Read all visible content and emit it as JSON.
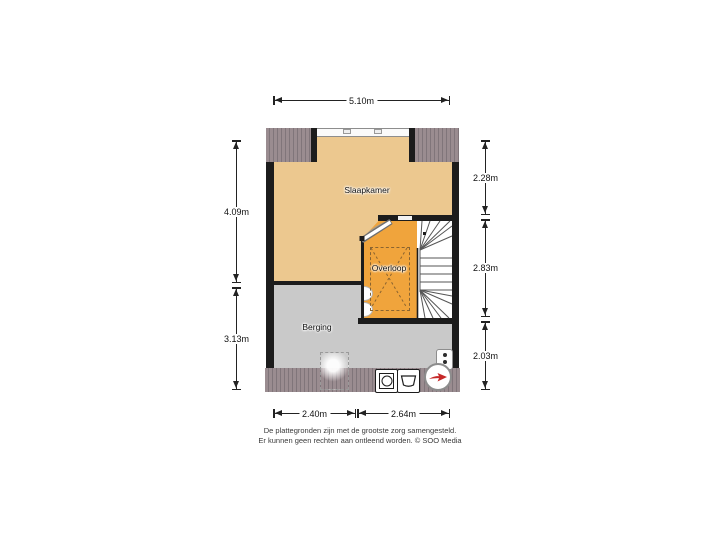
{
  "floorplan": {
    "rooms": {
      "bedroom": {
        "name": "Slaapkamer"
      },
      "landing": {
        "name": "Overloop"
      },
      "storage": {
        "name": "Berging"
      }
    },
    "dimensions": {
      "top": "5.10m",
      "left": [
        "4.09m",
        "3.13m"
      ],
      "right": [
        "2.28m",
        "2.83m",
        "2.03m"
      ],
      "bottom": [
        "2.40m",
        "2.64m"
      ]
    },
    "icons": [
      "washing-machine",
      "sink",
      "boiler",
      "compass-north-arrow"
    ],
    "colors": {
      "bedroom_floor": "#ecc88f",
      "landing_floor": "#f0a43c",
      "storage_floor": "#c9c9c9",
      "roof_hatch": "#9a8c90",
      "wall": "#1c1c1c",
      "compass_arrow": "#c62828"
    }
  },
  "disclaimer": {
    "line1": "De plattegronden zijn met de grootste zorg samengesteld.",
    "line2": "Er kunnen geen rechten aan ontleend worden. © SOO Media"
  }
}
